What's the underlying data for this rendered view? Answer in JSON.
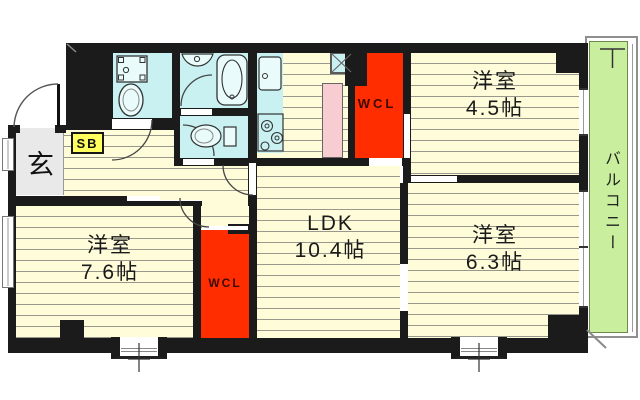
{
  "floorplan": {
    "rooms": {
      "west45": {
        "name": "洋室",
        "area": "4.5帖"
      },
      "west63": {
        "name": "洋室",
        "area": "6.3帖"
      },
      "west76": {
        "name": "洋室",
        "area": "7.6帖"
      },
      "ldk": {
        "name": "LDK",
        "area": "10.4帖"
      },
      "wcl_top": {
        "name": "WCL"
      },
      "wcl_bottom": {
        "name": "WCL"
      },
      "entrance": {
        "name": "玄"
      },
      "shoebox": {
        "name": "SB"
      },
      "balcony": {
        "name": "バルコニー"
      }
    },
    "colors": {
      "wall": "#1b1b1b",
      "floor": "#fffcda",
      "floor-stripe": "#98988c",
      "wet": "#c9f1f2",
      "fixture": "#e9fbfb",
      "closet": "#ff2d00",
      "storage": "#f7cdd1",
      "balcony": "#c9ef9e",
      "shoebox": "#ffff5e",
      "entrance": "#e9e9e9"
    }
  }
}
